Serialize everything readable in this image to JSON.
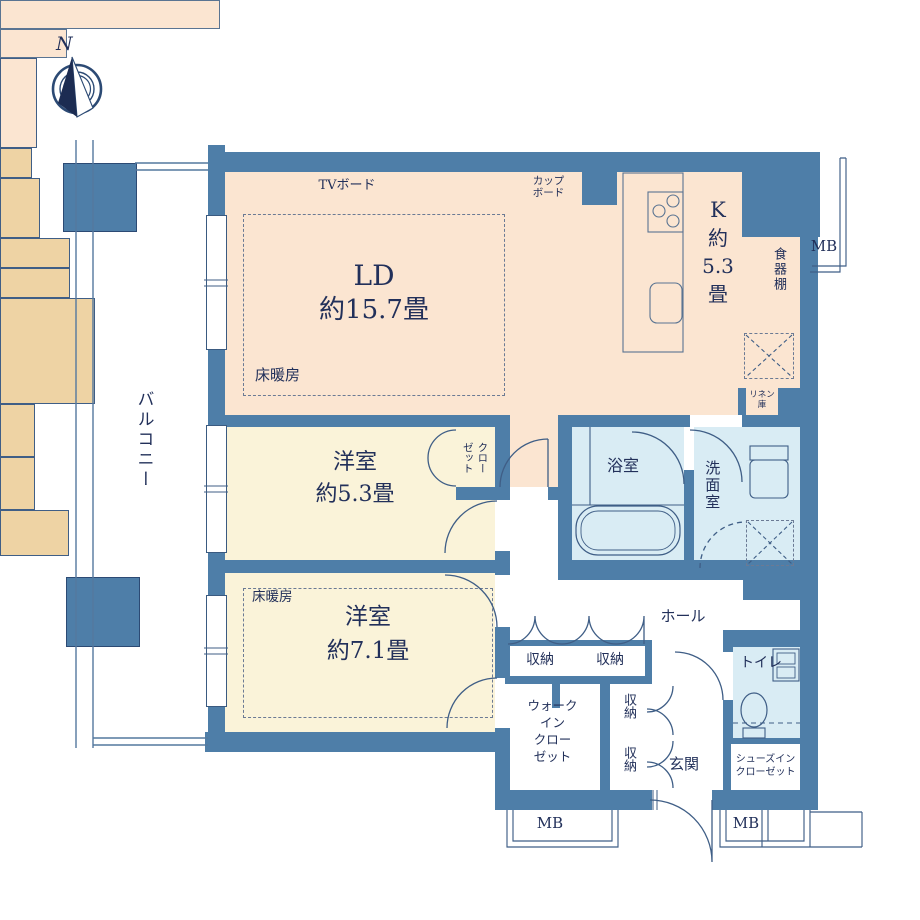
{
  "compass": {
    "north": "N"
  },
  "balcony": {
    "label": "バルコニー"
  },
  "living_dining": {
    "name": "LD",
    "size": "約15.7畳",
    "floor_heating": "床暖房",
    "tv_board": "TVボード",
    "cupboard_line1": "カップ",
    "cupboard_line2": "ボード"
  },
  "kitchen": {
    "name": "K",
    "approx": "約",
    "size": "5.3",
    "unit": "畳",
    "dish_shelf": "食器棚",
    "linen_line1": "リネン",
    "linen_line2": "庫"
  },
  "bathroom": {
    "label": "浴室"
  },
  "washroom": {
    "label": "洗面室"
  },
  "toilet": {
    "label": "トイレ"
  },
  "hall": {
    "label": "ホール"
  },
  "entrance": {
    "label": "玄関"
  },
  "bedroom1": {
    "name": "洋室",
    "size": "約5.3畳",
    "closet_line1": "クロー",
    "closet_line2": "ゼット"
  },
  "bedroom2": {
    "name": "洋室",
    "size": "約7.1畳",
    "floor_heating": "床暖房"
  },
  "walk_in_closet": {
    "line1": "ウォーク",
    "line2": "イン",
    "line3": "クロー",
    "line4": "ゼット"
  },
  "shoes_in_closet": {
    "line1": "シューズイン",
    "line2": "クローゼット"
  },
  "storage": {
    "label": "収納"
  },
  "meter_box": {
    "label": "MB"
  },
  "colors": {
    "wall": "#4e7ea8",
    "ld_floor": "#fbe5d1",
    "bedroom_floor": "#faf3d9",
    "wet_floor": "#d9ecf4",
    "storage_fill": "#eed3a4",
    "text": "#22305a"
  }
}
